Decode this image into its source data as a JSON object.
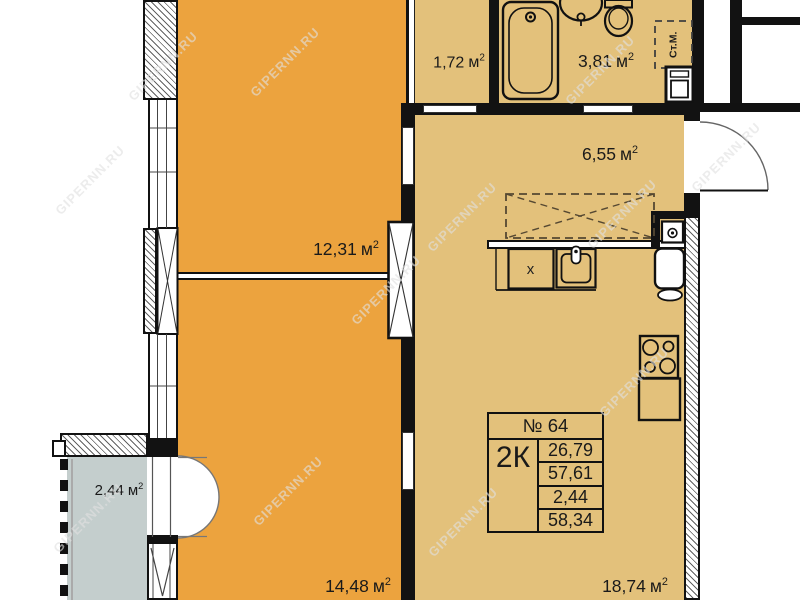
{
  "watermark": {
    "text": "GIPERNN.RU"
  },
  "units": {
    "area_unit": "м",
    "area_sup": "2"
  },
  "rooms": [
    {
      "name": "storage",
      "value": "1,72"
    },
    {
      "name": "bathroom",
      "value": "3,81"
    },
    {
      "name": "hallway",
      "value": "6,55"
    },
    {
      "name": "living-room-1",
      "value": "12,31"
    },
    {
      "name": "balcony",
      "value": "2,44"
    },
    {
      "name": "living-room-2",
      "value": "14,48"
    },
    {
      "name": "kitchen-living",
      "value": "18,74"
    }
  ],
  "info_box": {
    "number": "№ 64",
    "type": "2К",
    "rows": [
      "26,79",
      "57,61",
      "2,44",
      "58,34"
    ]
  },
  "fixtures": {
    "washing_machine": "Ст.М.",
    "counter_mark": "x"
  },
  "colors": {
    "room_orange": "#ECA33E",
    "room_tan": "#E3C17B",
    "balcony": "#C4CECD",
    "wall": "#121212"
  }
}
